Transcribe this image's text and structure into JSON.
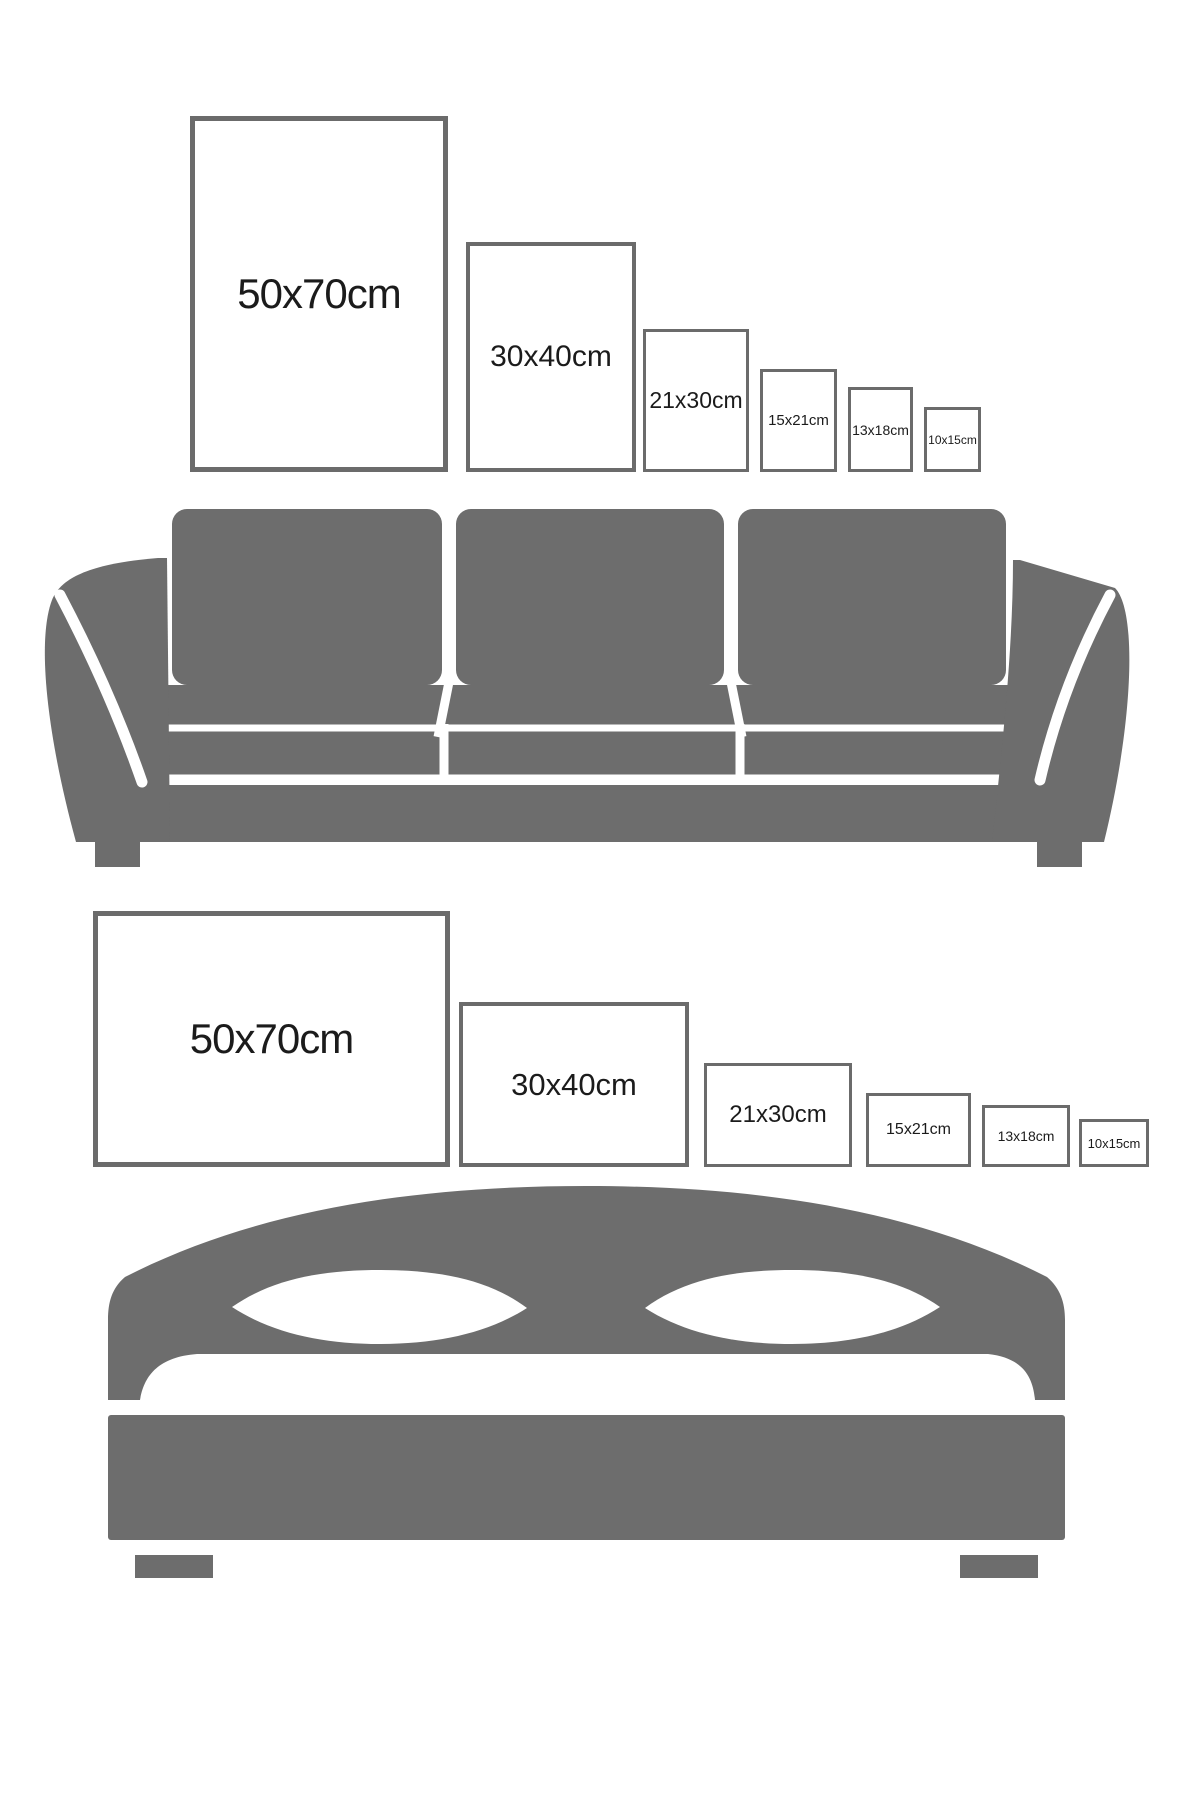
{
  "page": {
    "background": "#ffffff",
    "description": "Poster size comparison guide above sofa and bed silhouettes"
  },
  "colors": {
    "furniture_gray": "#6d6d6d",
    "frame_border": "#6b6b6b",
    "label_text": "#1b1b1b"
  },
  "sections": [
    {
      "name": "portrait-sizes-over-sofa",
      "orientation": "portrait",
      "furniture": {
        "name": "sofa"
      },
      "frames": [
        {
          "label": "50x70cm"
        },
        {
          "label": "30x40cm"
        },
        {
          "label": "21x30cm"
        },
        {
          "label": "15x21cm"
        },
        {
          "label": "13x18cm"
        },
        {
          "label": "10x15cm"
        }
      ]
    },
    {
      "name": "landscape-sizes-over-bed",
      "orientation": "landscape",
      "furniture": {
        "name": "bed"
      },
      "frames": [
        {
          "label": "50x70cm"
        },
        {
          "label": "30x40cm"
        },
        {
          "label": "21x30cm"
        },
        {
          "label": "15x21cm"
        },
        {
          "label": "13x18cm"
        },
        {
          "label": "10x15cm"
        }
      ]
    }
  ]
}
